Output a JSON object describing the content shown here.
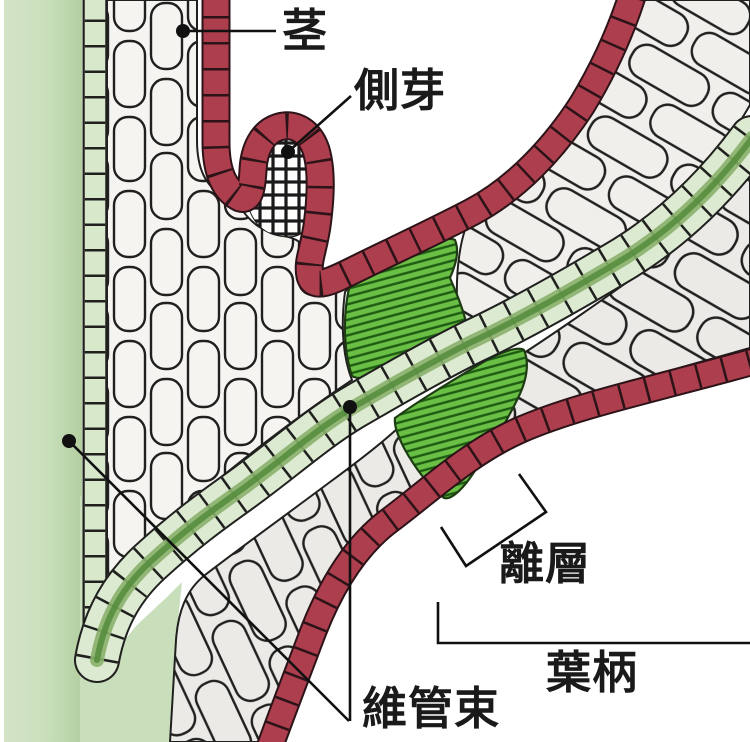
{
  "figure": {
    "type": "botanical-cross-section-diagram",
    "labels": {
      "stem": "茎",
      "lateral_bud": "側芽",
      "abscission_layer": "離層",
      "petiole": "葉柄",
      "vascular_bundle": "維管束"
    },
    "colors": {
      "epidermis_red": "#ad3e4d",
      "abscission_green": "#6abf45",
      "abscission_hatch_green": "#1d5c12",
      "vascular_cell_green": "#d8e9cb",
      "vascular_core_green": "#548c3c",
      "stem_ground_green": "#c9dfbc",
      "cell_white": "#f4f3f0",
      "petiole_cell_grey": "#ebeae6",
      "outline_black": "#1a1a1a"
    }
  }
}
